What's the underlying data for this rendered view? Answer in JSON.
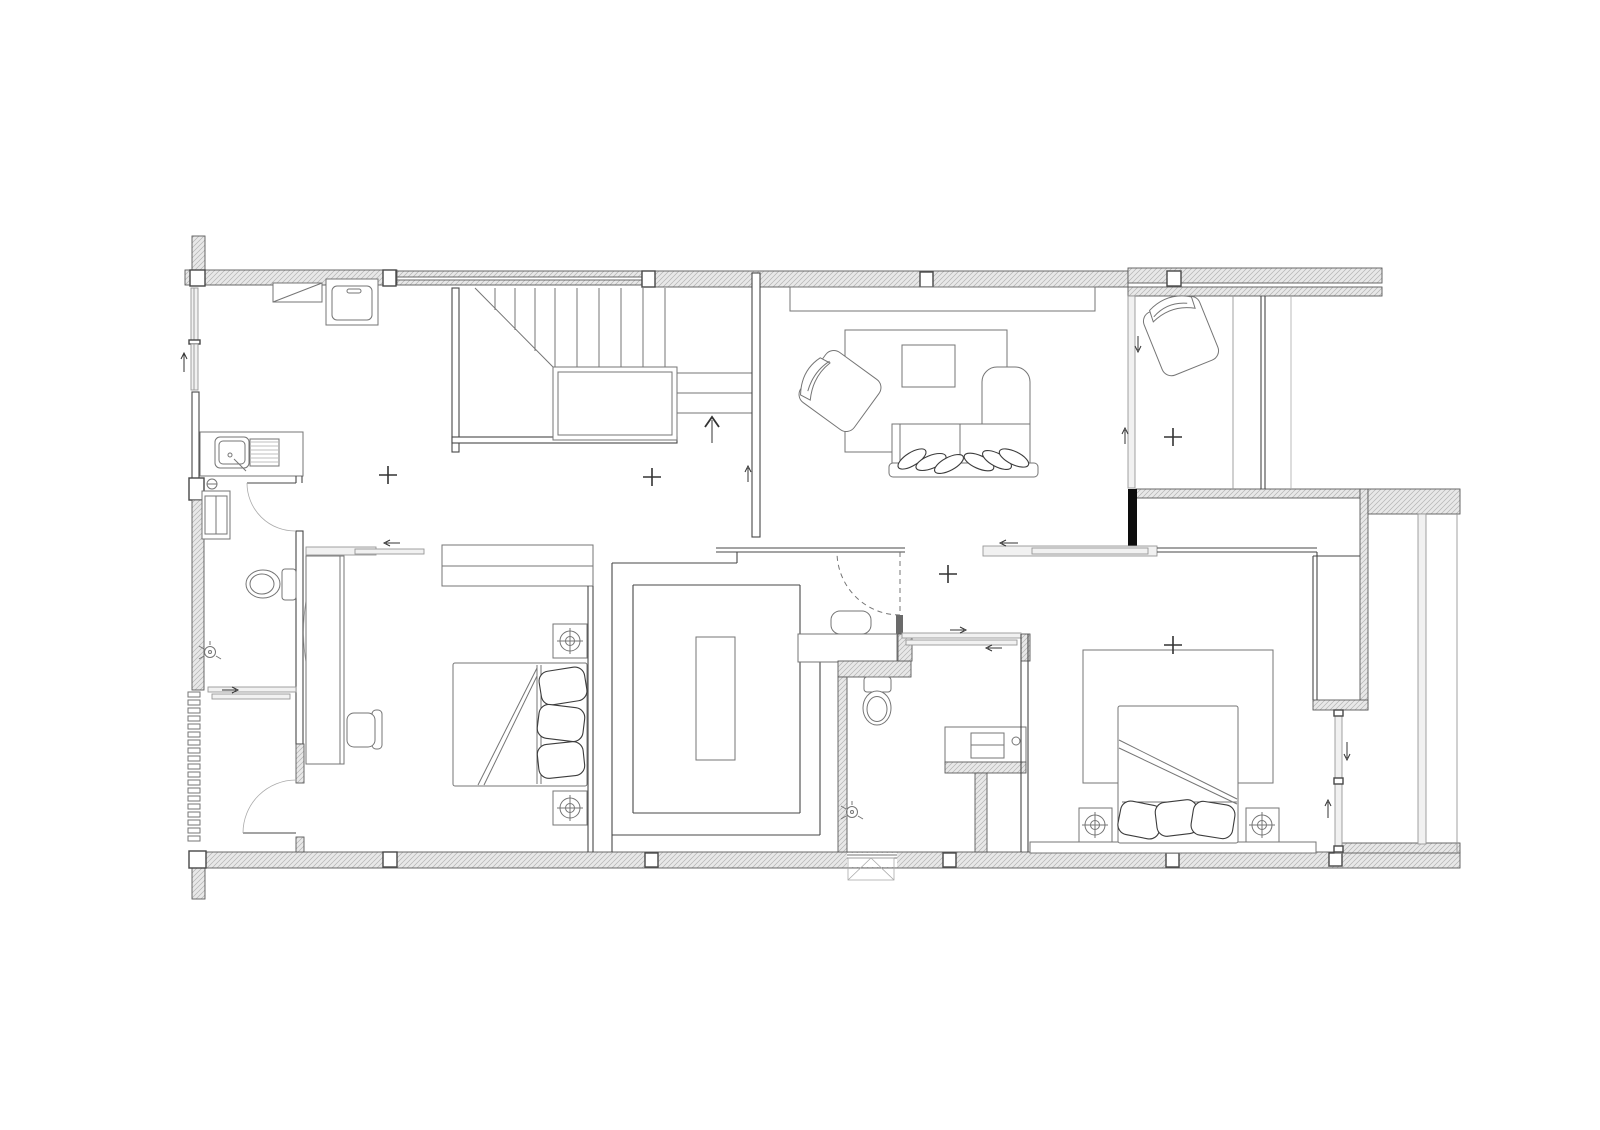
{
  "meta": {
    "drawing_type": "architectural-floor-plan",
    "view": "second-floor-plan-top-view",
    "visible_text_labels": [],
    "canvas": {
      "width": 1600,
      "height": 1130
    }
  },
  "palette": {
    "background": "#ffffff",
    "wall_hatch": "#e8e8e8",
    "wall_hatch_line": "#b3b3b3",
    "wall_outline": "#5a5a5a",
    "partition": "#474747",
    "furniture_line": "#757575",
    "furniture_strong": "#3c3c3c",
    "accent_black": "#0d0d0d",
    "glass": "#f1f1f1",
    "glass_line": "#979797",
    "marker": "#333333",
    "light_line": "#aaaaaa"
  },
  "rooms": [
    {
      "id": "laundry-kitchenette",
      "furniture": [
        "counter-with-diagonal",
        "washing-machine",
        "sink-counter-with-drainboard"
      ]
    },
    {
      "id": "stair-hall",
      "furniture": [
        "u-shaped-staircase",
        "landing",
        "up-direction-arrow"
      ]
    },
    {
      "id": "living-room",
      "furniture": [
        "wall-tv",
        "tv-console",
        "rug",
        "coffee-table",
        "rotated-armchair",
        "sofa-with-chaise",
        "six-throw-pillows"
      ]
    },
    {
      "id": "terrace-room",
      "furniture": [
        "rotated-armchair",
        "sliding-glass-doors"
      ]
    },
    {
      "id": "bathroom-left",
      "furniture": [
        "cabinet",
        "toilet",
        "shower-head",
        "sliding-shower-door",
        "swing-doors"
      ]
    },
    {
      "id": "bedroom-1",
      "furniture": [
        "desk-counter",
        "desk-chair",
        "double-bed-with-pillows",
        "two-nightstand-lamps",
        "built-in-wardrobe",
        "sliding-entry-door"
      ]
    },
    {
      "id": "walk-in-closet",
      "furniture": [
        "c-shaped-wardrobe",
        "island-dresser",
        "stool",
        "vanity-counter",
        "hidden-swing-door-dashed"
      ]
    },
    {
      "id": "bathroom-middle",
      "furniture": [
        "toilet",
        "vanity-with-sink",
        "shower-head",
        "double-sliding-door"
      ]
    },
    {
      "id": "bedroom-2",
      "furniture": [
        "rug",
        "double-bed-with-pillows",
        "two-nightstand-lamps",
        "reach-in-wardrobe",
        "headboard-platform",
        "sliding-entry-door"
      ]
    },
    {
      "id": "balcony-terrace-right",
      "furniture": [
        "glass-rail-lines"
      ]
    }
  ],
  "symbols": {
    "cross_position_markers": 5,
    "column_blocks_top_wall": 5,
    "column_blocks_bottom_wall": 6,
    "door_swing_arcs": 3,
    "dashed_door_arcs": 1,
    "sliding_door_tracks": 5,
    "stair_up_arrows": 1,
    "window_opening_arrows": 6,
    "louver_slats_left_wall": 19,
    "vent_box_bottom_wall": 1
  }
}
